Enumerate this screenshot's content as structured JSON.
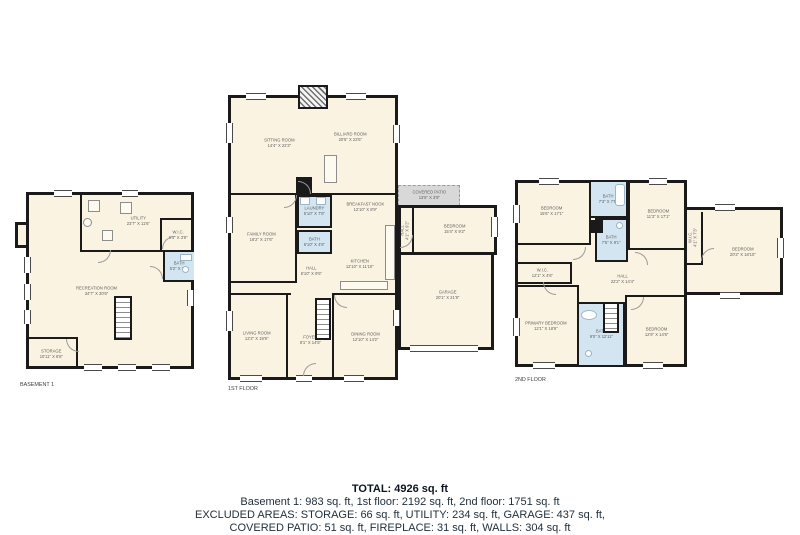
{
  "colors": {
    "wall": "#1a1a1a",
    "room": "#faf3e2",
    "bath": "#d2e5f1",
    "patio": "#d8d8d8",
    "rmtext": "#606060",
    "sumtext": "#22303d"
  },
  "floors": [
    {
      "label": "BASEMENT 1",
      "rooms": [
        {
          "name": "UTILITY",
          "dims": "23'7\" X 11'6\""
        },
        {
          "name": "W.I.C.",
          "dims": "6'1\" X 3'9\""
        },
        {
          "name": "BATH",
          "dims": "5'2\" X 7'9\""
        },
        {
          "name": "RECREATION ROOM",
          "dims": "34'7\" X 30'6\""
        },
        {
          "name": "STORAGE",
          "dims": "10'11\" X 6'6\""
        }
      ]
    },
    {
      "label": "1ST FLOOR",
      "rooms": [
        {
          "name": "SITTING ROOM",
          "dims": "14'4\" X 22'3\""
        },
        {
          "name": "BILLIARD ROOM",
          "dims": "20'5\" X 22'5\""
        },
        {
          "name": "FAMILY ROOM",
          "dims": "16'2\" X 17'6\""
        },
        {
          "name": "LAUNDRY",
          "dims": "5'10\" X 7'6\""
        },
        {
          "name": "BATH",
          "dims": "6'10\" X 4'6\""
        },
        {
          "name": "BREAKFAST NOOK",
          "dims": "12'10\" X 8'9\""
        },
        {
          "name": "KITCHEN",
          "dims": "12'10\" X 11'10\""
        },
        {
          "name": "HALL",
          "dims": "6'10\" X 9'5\""
        },
        {
          "name": "LIVING ROOM",
          "dims": "12'2\" X 19'9\""
        },
        {
          "name": "FOYER",
          "dims": "8'1\" X 14'5\""
        },
        {
          "name": "DINING ROOM",
          "dims": "12'10\" X 14'2\""
        },
        {
          "name": "COVERED PATIO",
          "dims": "13'5\" X 3'9\""
        },
        {
          "name": "HALL",
          "dims": "4'1\" X 9'2\""
        },
        {
          "name": "BEDROOM",
          "dims": "15'4\" X 9'2\""
        },
        {
          "name": "GARAGE",
          "dims": "20'1\" X 21'9\""
        }
      ]
    },
    {
      "label": "2ND FLOOR",
      "rooms": [
        {
          "name": "BEDROOM",
          "dims": "15'6\" X 17'1\""
        },
        {
          "name": "BATH",
          "dims": "7'3\" X 7'5\""
        },
        {
          "name": "BEDROOM",
          "dims": "11'3\" X 17'1\""
        },
        {
          "name": "BATH",
          "dims": "7'5\" X 9'1\""
        },
        {
          "name": "W.I.C.",
          "dims": "12'1\" X 4'6\""
        },
        {
          "name": "HALL",
          "dims": "22'2\" X 14'4\""
        },
        {
          "name": "PRIMARY BEDROOM",
          "dims": "12'1\" X 18'6\""
        },
        {
          "name": "BATH",
          "dims": "9'0\" X 12'11\""
        },
        {
          "name": "BEDROOM",
          "dims": "12'9\" X 14'6\""
        },
        {
          "name": "W.I.C.",
          "dims": "4'1\" X 7'3\""
        },
        {
          "name": "BEDROOM",
          "dims": "20'2\" X 18'10\""
        }
      ]
    }
  ],
  "summary": {
    "total": "TOTAL: 4926 sq. ft",
    "line1": "Basement 1: 983 sq. ft, 1st floor: 2192 sq. ft, 2nd floor: 1751 sq. ft",
    "line2": "EXCLUDED AREAS: STORAGE: 66 sq. ft, UTILITY: 234 sq. ft, GARAGE: 437 sq. ft,",
    "line3": "COVERED PATIO: 51 sq. ft, FIREPLACE: 31 sq. ft, WALLS: 304 sq. ft"
  }
}
